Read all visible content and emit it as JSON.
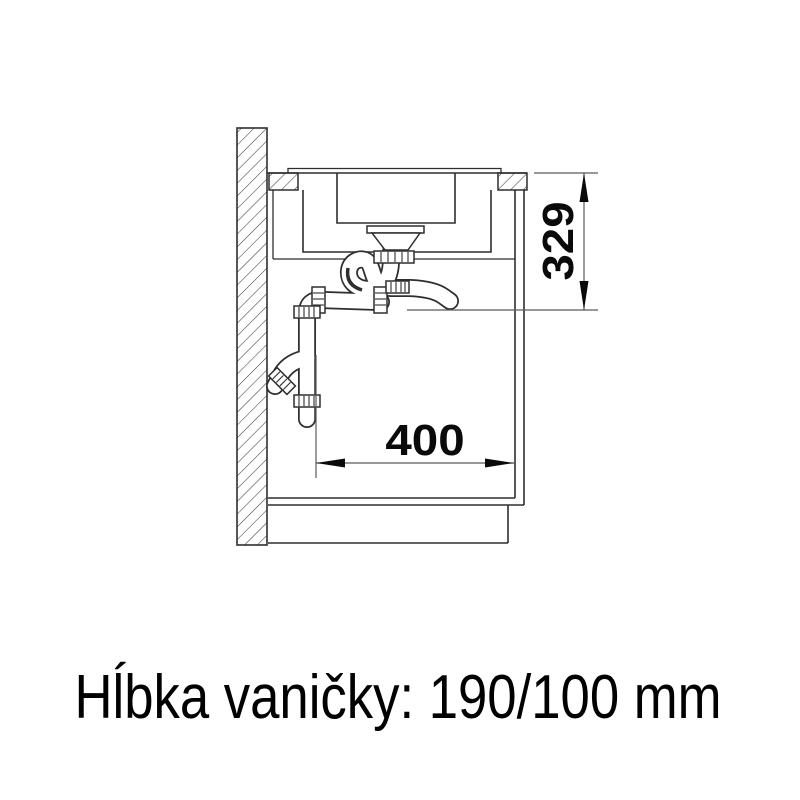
{
  "diagram": {
    "dimensions": {
      "width_mm": "400",
      "height_mm": "329"
    },
    "caption": "Hĺbka vaničky: 190/100 mm",
    "colors": {
      "line": "#2e2e2e",
      "dimension_line": "#5a5a5a",
      "text": "#000000",
      "background": "#ffffff"
    }
  }
}
